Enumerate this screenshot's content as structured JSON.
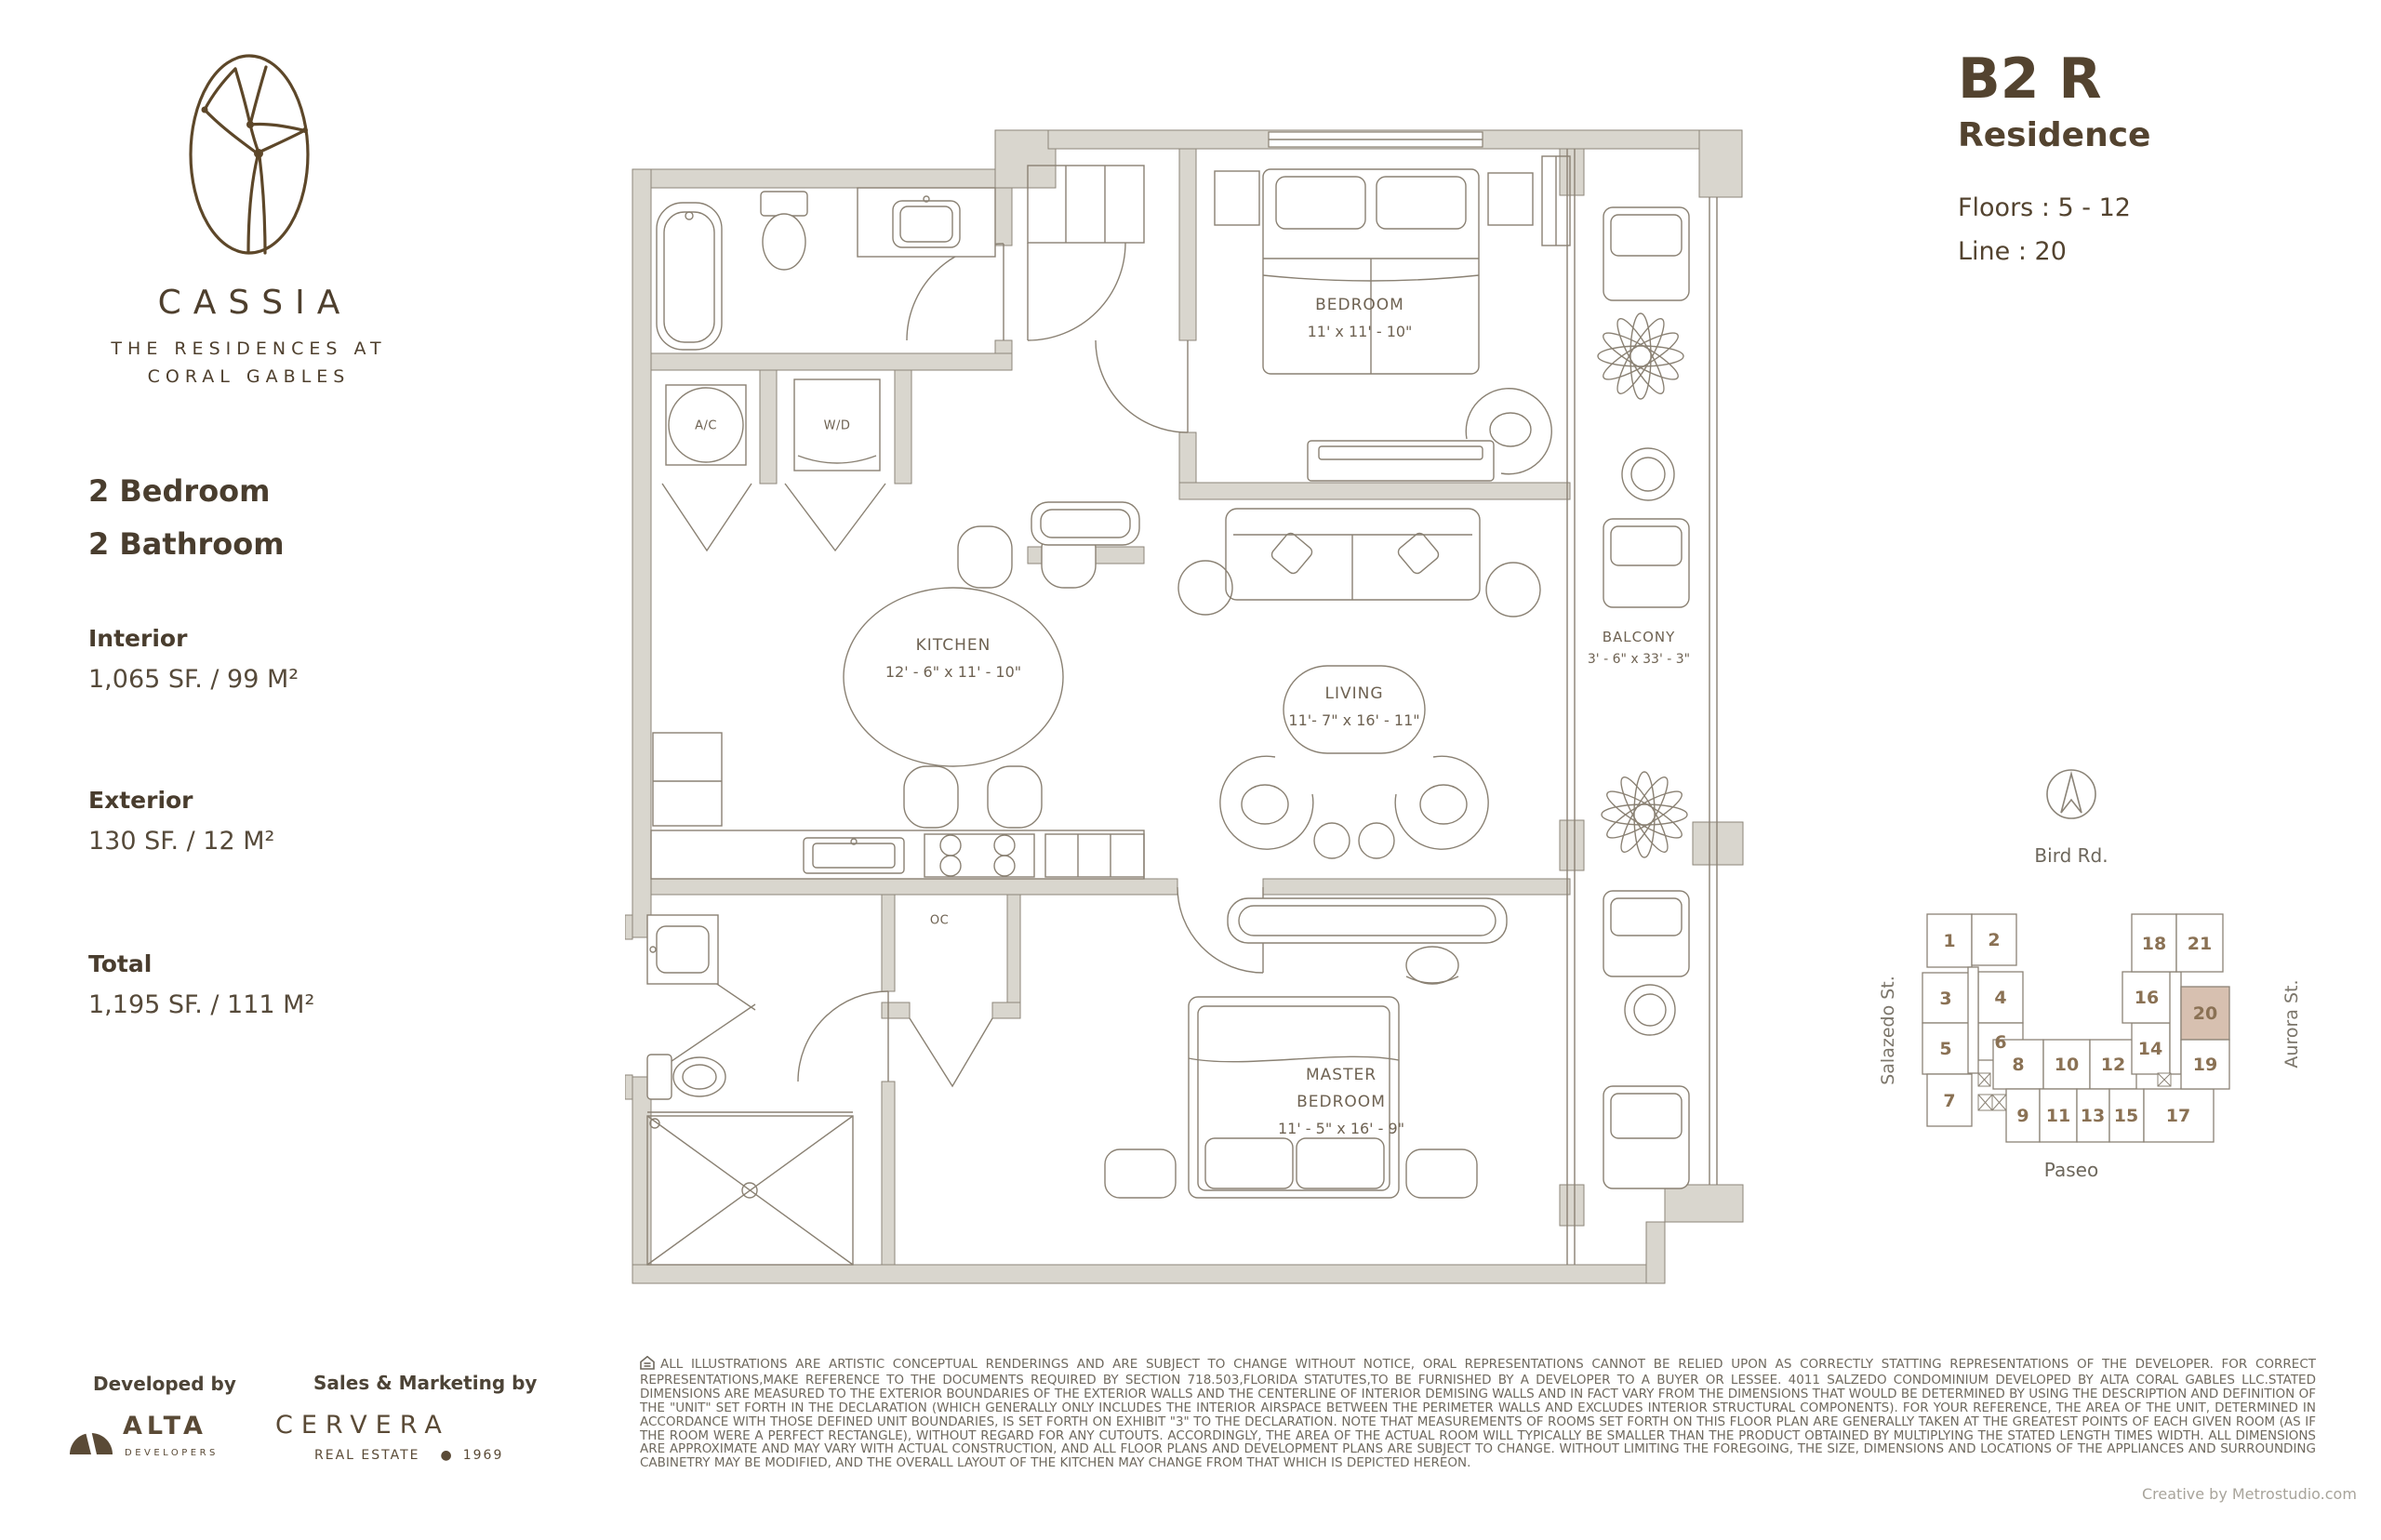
{
  "brand": {
    "name": "CASSIA",
    "subtitle_line1": "THE RESIDENCES AT",
    "subtitle_line2": "CORAL GABLES"
  },
  "unit_summary": {
    "bedrooms": "2 Bedroom",
    "bathrooms": "2 Bathroom",
    "interior_label": "Interior",
    "interior_value": "1,065 SF. / 99 M²",
    "exterior_label": "Exterior",
    "exterior_value": "130 SF. / 12 M²",
    "total_label": "Total",
    "total_value": "1,195 SF. / 111 M²"
  },
  "residence": {
    "code": "B2 R",
    "type_label": "Residence",
    "floors": "Floors : 5 - 12",
    "line": "Line : 20"
  },
  "floor_plan": {
    "rooms": {
      "bedroom": {
        "name": "BEDROOM",
        "dims": "11' x 11' - 10\""
      },
      "kitchen": {
        "name": "KITCHEN",
        "dims": "12' - 6\" x 11' - 10\""
      },
      "living": {
        "name": "LIVING",
        "dims": "11'- 7\" x 16' - 11\""
      },
      "balcony": {
        "name": "BALCONY",
        "dims": "3' - 6\" x 33' - 3\""
      },
      "master_bedroom": {
        "name_line1": "MASTER",
        "name_line2": "BEDROOM",
        "dims": "11' - 5\" x 16' - 9\""
      },
      "ac": "A/C",
      "wd": "W/D",
      "oc": "OC"
    }
  },
  "keymap": {
    "north_label": "Bird Rd.",
    "street_left": "Salazedo St.",
    "street_right": "Aurora St.",
    "street_bottom": "Paseo",
    "highlighted_unit": "20",
    "units": [
      "1",
      "2",
      "3",
      "4",
      "5",
      "6",
      "7",
      "8",
      "9",
      "10",
      "11",
      "12",
      "13",
      "14",
      "15",
      "16",
      "17",
      "18",
      "19",
      "20",
      "21"
    ],
    "highlight_color": "#d7c0b0"
  },
  "footer": {
    "developed_by_label": "Developed by",
    "developer_name": "ALTA",
    "developer_sub": "DEVELOPERS",
    "sales_label": "Sales & Marketing by",
    "sales_name": "CERVERA",
    "sales_sub": "REAL ESTATE",
    "sales_year": "1969",
    "disclaimer": "ALL ILLUSTRATIONS ARE ARTISTIC CONCEPTUAL RENDERINGS AND ARE SUBJECT TO CHANGE WITHOUT NOTICE, ORAL REPRESENTATIONS CANNOT BE RELIED UPON AS CORRECTLY STATTING REPRESENTATIONS OF THE DEVELOPER. FOR CORRECT REPRESENTATIONS,MAKE REFERENCE TO THE DOCUMENTS REQUIRED BY SECTION 718.503,FLORIDA STATUTES,TO BE FURNISHED BY A DEVELOPER TO A BUYER OR LESSEE. 4011 SALZEDO CONDOMINIUM DEVELOPED BY ALTA CORAL GABLES LLC.STATED DIMENSIONS ARE MEASURED TO THE EXTERIOR BOUNDARIES OF THE EXTERIOR WALLS AND THE CENTERLINE OF INTERIOR DEMISING WALLS AND IN FACT VARY FROM THE DIMENSIONS THAT WOULD BE DETERMINED BY USING THE DESCRIPTION AND DEFINITION OF THE \"UNIT\" SET FORTH IN THE DECLARATION (WHICH GENERALLY ONLY INCLUDES THE INTERIOR AIRSPACE BETWEEN THE PERIMETER WALLS AND EXCLUDES INTERIOR STRUCTURAL COMPONENTS).  FOR YOUR REFERENCE, THE AREA OF THE UNIT, DETERMINED IN ACCORDANCE WITH THOSE DEFINED UNIT BOUNDARIES, IS SET FORTH ON EXHIBIT \"3\" TO THE DECLARATION.  NOTE THAT MEASUREMENTS OF ROOMS SET FORTH ON THIS FLOOR PLAN ARE GENERALLY TAKEN AT THE GREATEST POINTS OF EACH GIVEN ROOM (AS IF THE ROOM WERE A PERFECT RECTANGLE), WITHOUT REGARD FOR ANY CUTOUTS.  ACCORDINGLY, THE AREA OF THE ACTUAL ROOM WILL TYPICALLY BE SMALLER THAN THE PRODUCT OBTAINED BY MULTIPLYING THE STATED LENGTH TIMES WIDTH.  ALL DIMENSIONS ARE APPROXIMATE AND MAY VARY WITH ACTUAL CONSTRUCTION, AND ALL FLOOR PLANS AND DEVELOPMENT PLANS ARE SUBJECT TO CHANGE.  WITHOUT LIMITING THE FOREGOING, THE SIZE, DIMENSIONS AND LOCATIONS OF THE APPLIANCES AND SURROUNDING CABINETRY MAY BE MODIFIED, AND THE OVERALL LAYOUT OF THE KITCHEN MAY CHANGE FROM THAT WHICH IS DEPICTED HEREON.",
    "credit": "Creative by Metrostudio.com"
  }
}
